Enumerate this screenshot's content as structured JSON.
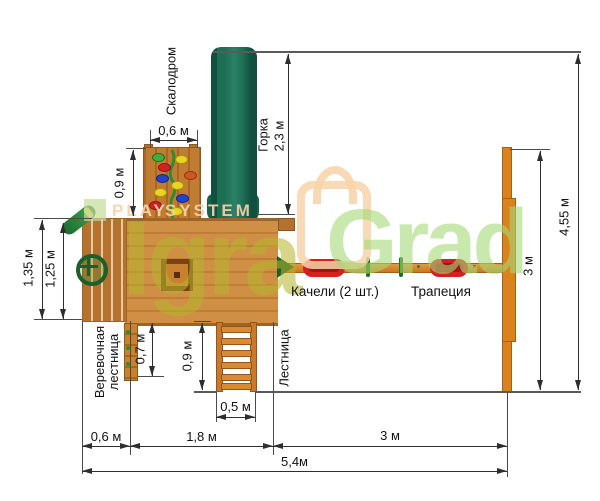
{
  "diagram": {
    "equipment_labels": {
      "climbing_wall": "Скалодром",
      "slide": "Горка",
      "swings": "Качели (2 шт.)",
      "trapeze": "Трапеция",
      "rope_ladder_line1": "Веревочная",
      "rope_ladder_line2": "лестница",
      "ladder": "Лестница"
    },
    "dimensions": {
      "climb_wall_width": "0,6 м",
      "climb_wall_height": "0,9 м",
      "slide_length": "2,3 м",
      "platform_depth_outer": "1,35 м",
      "platform_depth_inner": "1,25 м",
      "rope_ladder_drop": "0,7 м",
      "ladder_drop": "0,9 м",
      "ladder_width": "0,5 м",
      "left_section_width": "0,6 м",
      "platform_section_width": "1,8 м",
      "swing_section_width": "3 м",
      "total_width": "5,4м",
      "swing_beam_span": "3 м",
      "overall_depth": "4,55 м"
    },
    "watermark": {
      "play": "PLAY",
      "system": "SYSTEM",
      "brand_first": "Igra",
      "brand_second": "Grad"
    },
    "colors": {
      "wood": "#c9893f",
      "slide_green": "#17624a",
      "accent_green": "#1d5f2a",
      "seat_red": "#d42020",
      "beam_orange": "#d9831f",
      "dimension_line": "#2e2e2e",
      "watermark_olive": "#b5b62e",
      "watermark_green": "#a5d977",
      "watermark_peach": "#f8d3a9"
    }
  }
}
